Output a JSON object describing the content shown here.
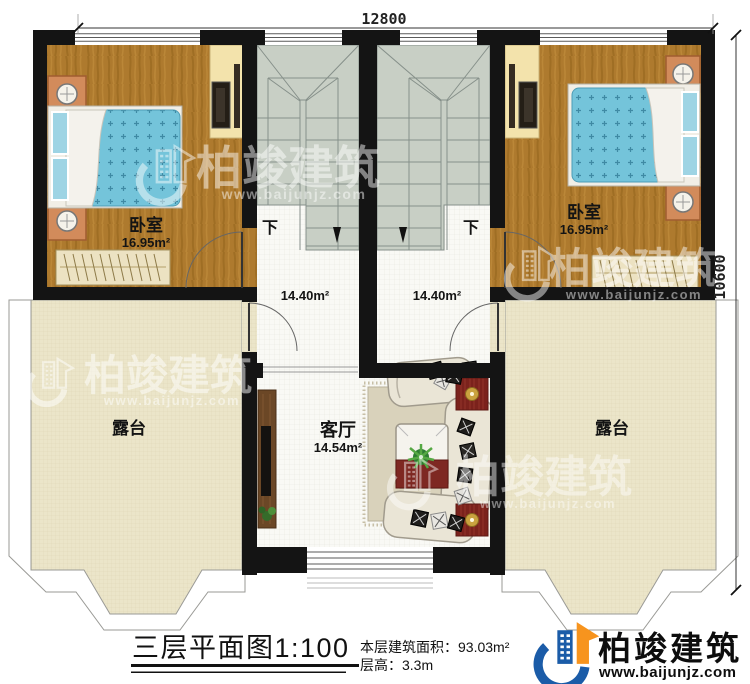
{
  "dimensions": {
    "top": "12800",
    "right": "10600"
  },
  "rooms": {
    "bedroom_left": {
      "name": "卧室",
      "area": "16.95m²"
    },
    "bedroom_right": {
      "name": "卧室",
      "area": "16.95m²"
    },
    "stairwell_left": {
      "area": "14.40m²",
      "direction": "下"
    },
    "stairwell_right": {
      "area": "14.40m²",
      "direction": "下"
    },
    "living_room": {
      "name": "客厅",
      "area": "14.54m²"
    },
    "terrace_left": {
      "name": "露台"
    },
    "terrace_right": {
      "name": "露台"
    }
  },
  "title_block": {
    "title": "三层平面图1:100",
    "area_note": "本层建筑面积：93.03m²",
    "height_note": "层高：3.3m"
  },
  "branding": {
    "company": "柏竣建筑",
    "website": "www.baijunjz.com",
    "blue": "#1b5ca8",
    "orange": "#f7941e"
  },
  "watermark": {
    "company": "柏竣建筑",
    "website": "www.baijunjz.com"
  }
}
